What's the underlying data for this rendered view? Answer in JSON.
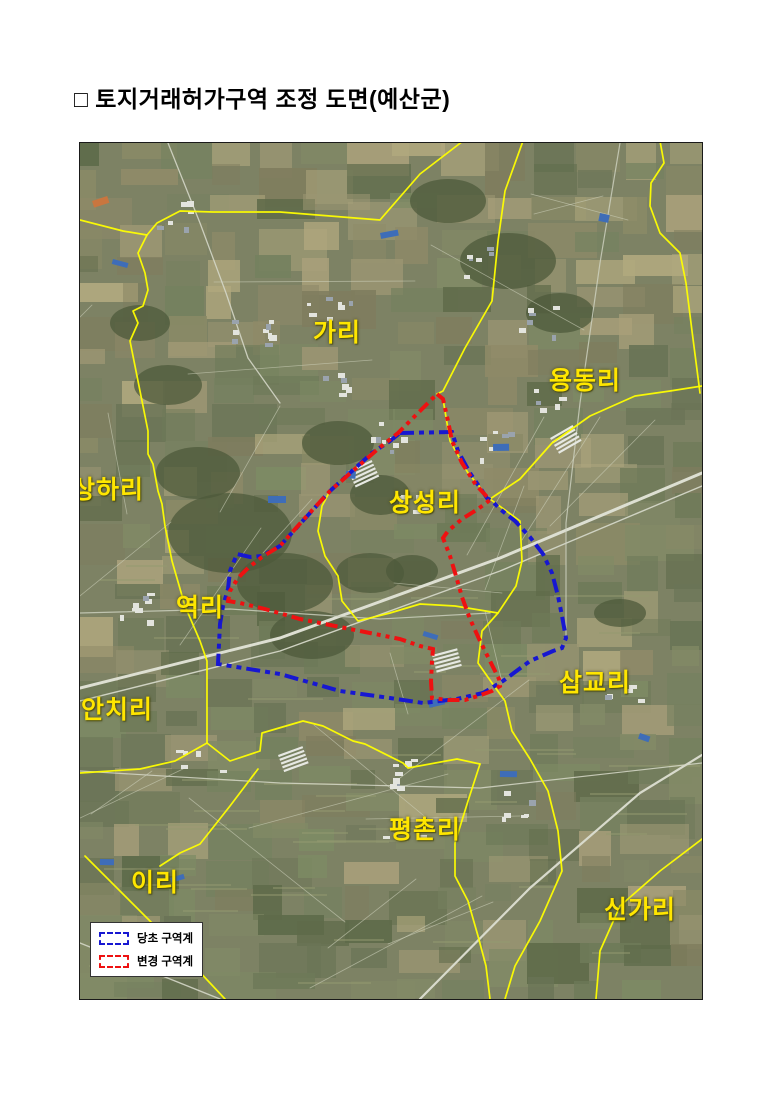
{
  "page": {
    "title": "□ 토지거래허가구역 조정 도면(예산군)"
  },
  "map": {
    "labels": [
      {
        "id": "gari",
        "text": "가리",
        "x": 257,
        "y": 188
      },
      {
        "id": "yongdong-ri",
        "text": "용동리",
        "x": 505,
        "y": 236
      },
      {
        "id": "sangha-ri",
        "text": "상하리",
        "x": 28,
        "y": 345
      },
      {
        "id": "sangseong-ri",
        "text": "상성리",
        "x": 345,
        "y": 358
      },
      {
        "id": "yeok-ri",
        "text": "역리",
        "x": 120,
        "y": 463
      },
      {
        "id": "sapgyo-ri",
        "text": "삽교리",
        "x": 515,
        "y": 538
      },
      {
        "id": "anchi-ri",
        "text": "안치리",
        "x": 37,
        "y": 565
      },
      {
        "id": "pyeongchon-ri",
        "text": "평촌리",
        "x": 345,
        "y": 685
      },
      {
        "id": "i-ri",
        "text": "이리",
        "x": 75,
        "y": 738
      },
      {
        "id": "singa-ri",
        "text": "신가리",
        "x": 560,
        "y": 765
      }
    ],
    "legend": {
      "items": [
        {
          "id": "original-zone",
          "label": "당초 구역계",
          "color": "#1717d1"
        },
        {
          "id": "changed-zone",
          "label": "변경 구역계",
          "color": "#ee1111"
        }
      ]
    },
    "colors": {
      "admin_boundary": "#ffff00",
      "label_text": "#ffe600"
    }
  }
}
